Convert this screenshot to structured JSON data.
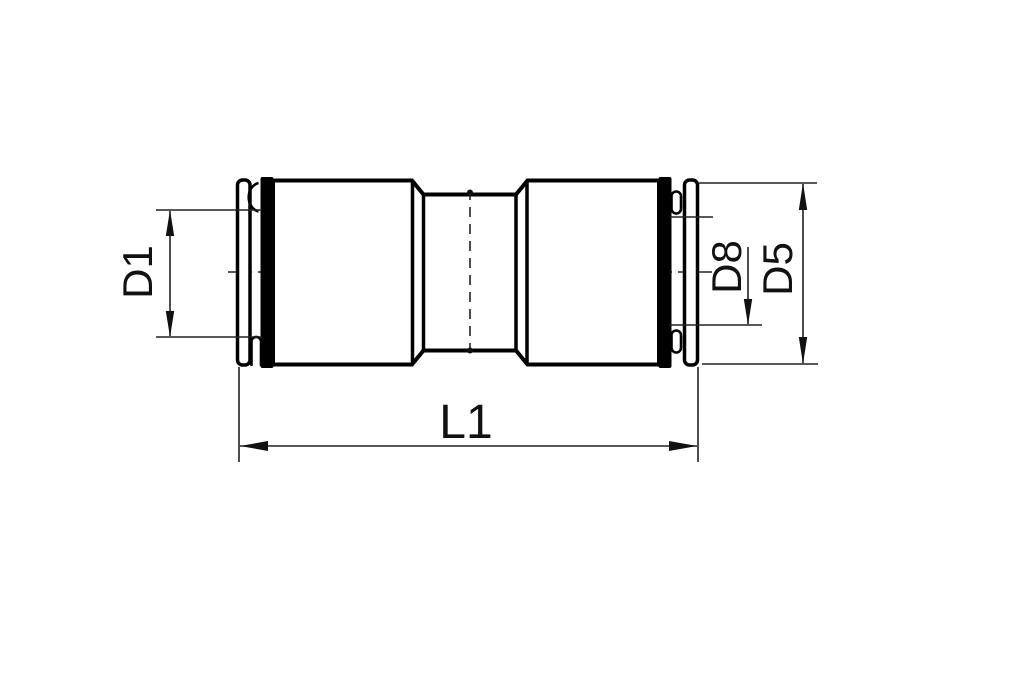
{
  "drawing": {
    "type": "technical-drawing",
    "view": "side-view straight push-in union fitting with dimension callouts",
    "labels": {
      "d1": "D1",
      "d8": "D8",
      "d5": "D5",
      "l1": "L1"
    },
    "colors": {
      "background": "#ffffff",
      "outline": "#000000",
      "dimension_lines": "#222222",
      "text": "#111111"
    }
  }
}
